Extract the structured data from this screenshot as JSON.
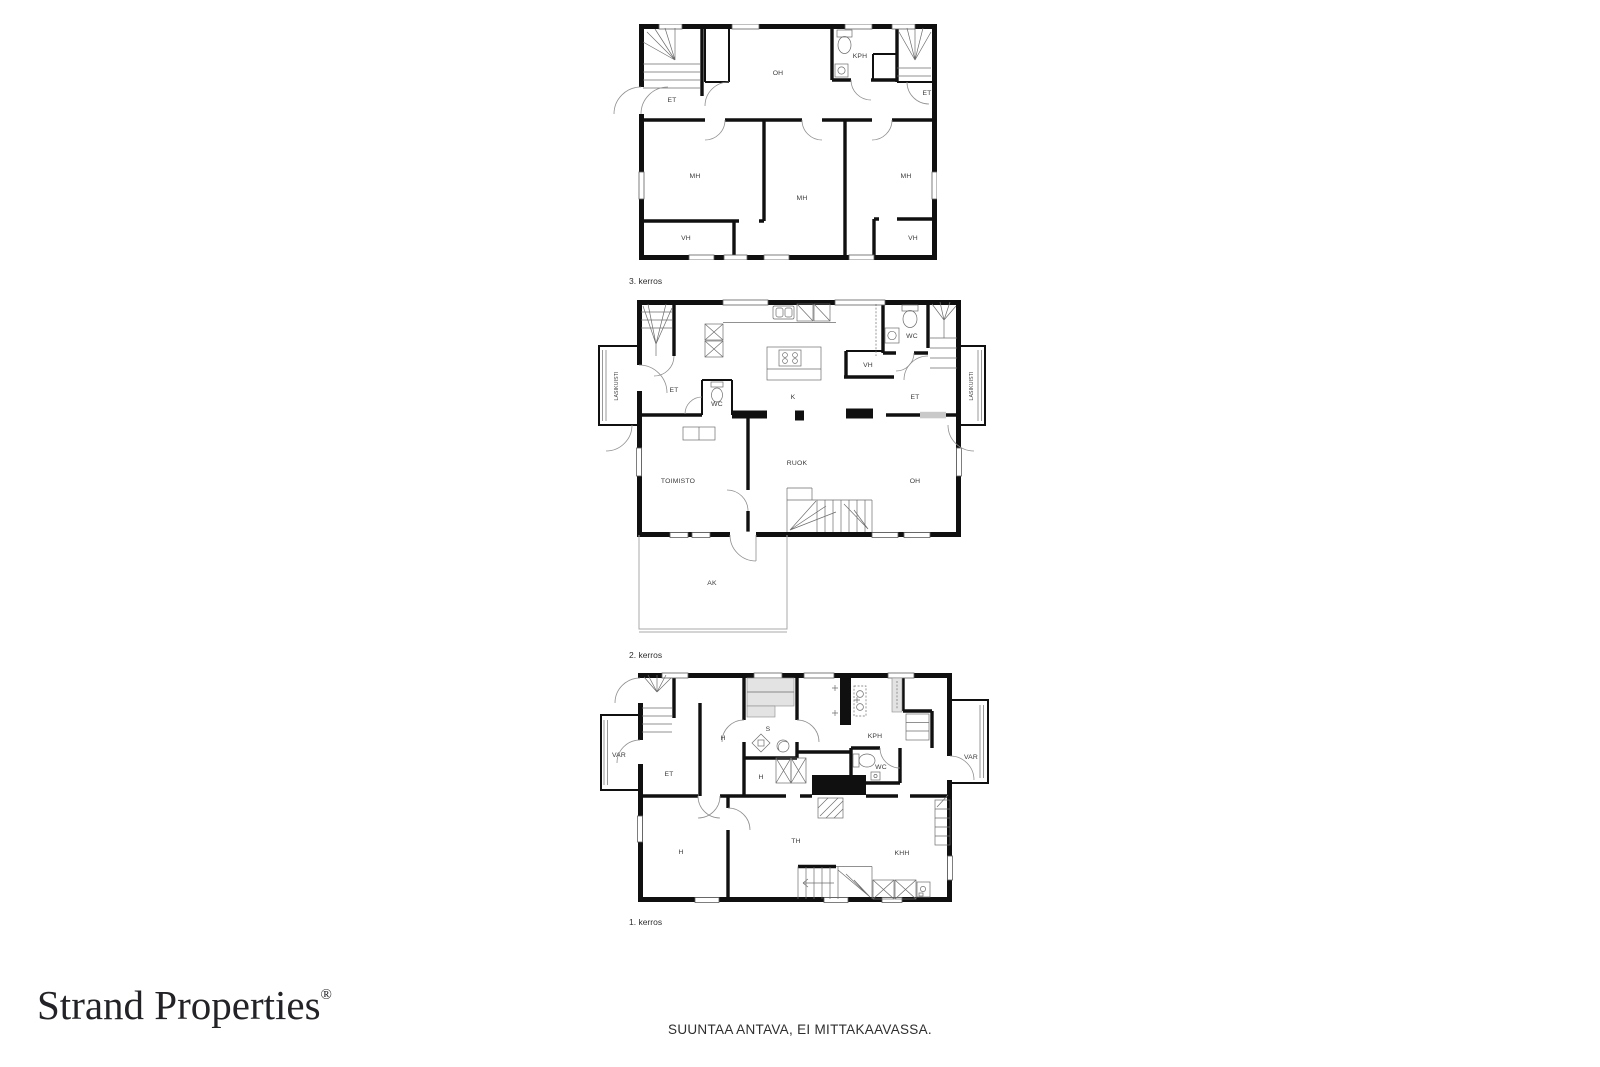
{
  "page": {
    "disclaimer": "SUUNTAA ANTAVA, EI MITTAKAAVASSA.",
    "brand_name": "Strand Properties",
    "brand_mark": "®",
    "wall_color": "#101010",
    "bench_color": "#e3e3e3",
    "label_color": "#3a3a3a"
  },
  "floors": {
    "f3": {
      "label": "3. kerros",
      "rooms": {
        "et_left": "ET",
        "oh": "OH",
        "kph": "KPH",
        "et_right": "ET",
        "mh_left": "MH",
        "mh_mid": "MH",
        "mh_right": "MH",
        "vh_left": "VH",
        "vh_right": "VH"
      }
    },
    "f2": {
      "label": "2. kerros",
      "rooms": {
        "lasikuisti_left": "LASIKUISTI",
        "lasikuisti_right": "LASIKUISTI",
        "et_left": "ET",
        "wc_left": "WC",
        "k": "K",
        "vh": "VH",
        "wc_right": "WC",
        "et_right": "ET",
        "toimisto": "TOIMISTO",
        "ruok": "RUOK",
        "oh": "OH",
        "ak": "AK"
      }
    },
    "f1": {
      "label": "1. kerros",
      "rooms": {
        "var_left": "VAR",
        "et": "ET",
        "h_hall": "H",
        "s": "S",
        "kph": "KPH",
        "wc": "WC",
        "var_right": "VAR",
        "h_small": "H",
        "h_room": "H",
        "th": "TH",
        "khh": "KHH"
      }
    }
  }
}
